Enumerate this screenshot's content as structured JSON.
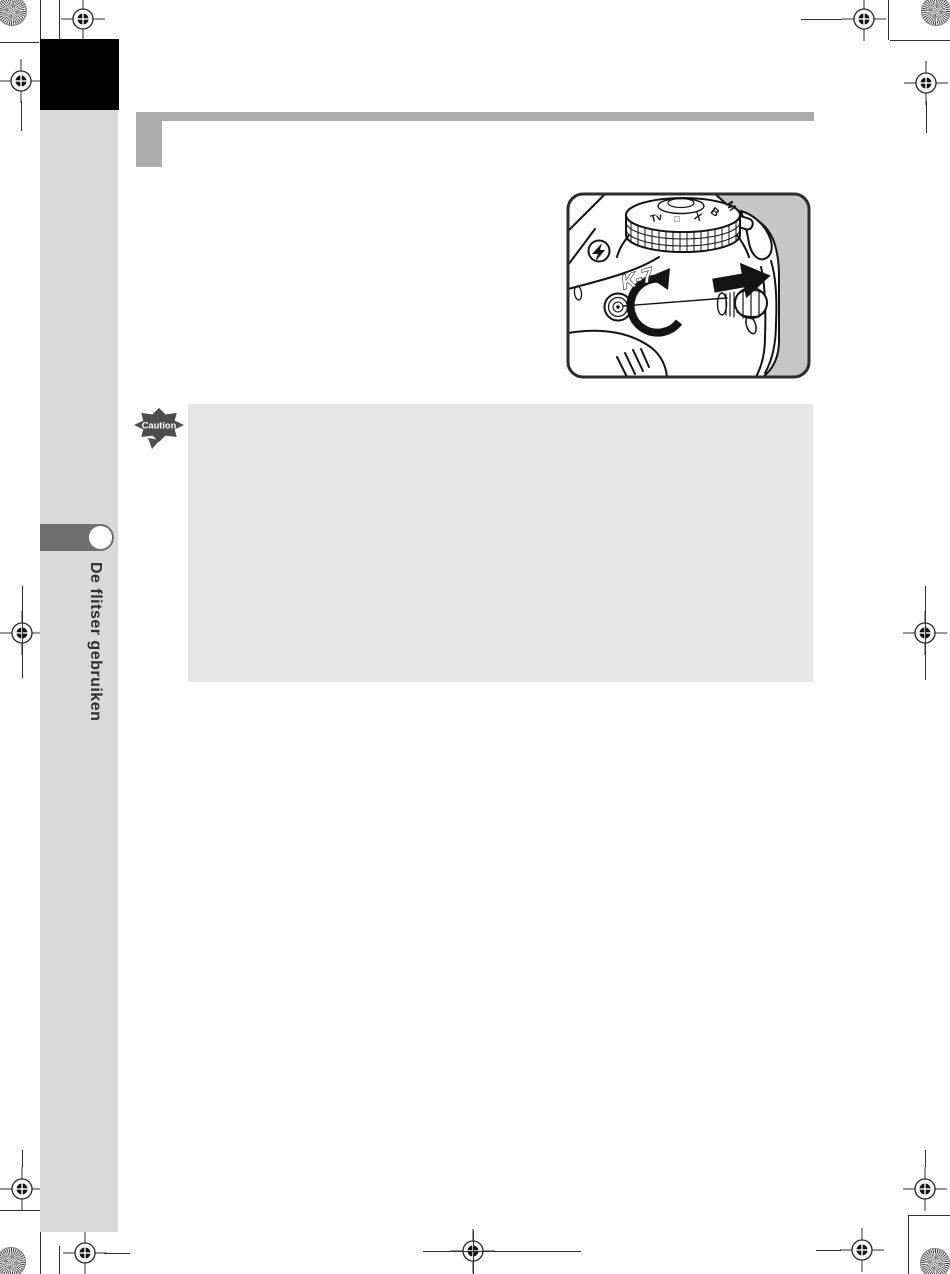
{
  "sidebar": {
    "tab_label": "De flitser gebruiken",
    "band_color": "#d9d9d9",
    "chapter_tab_color": "#000000",
    "pill_color": "#6f6f6f"
  },
  "header": {
    "bar_color": "#ababab"
  },
  "caution": {
    "label": "Caution",
    "icon_color": "#4d4d4d",
    "box_color": "#e7e7e7"
  },
  "illustration": {
    "model": "K-7",
    "dial_marks": [
      "Tv",
      "□",
      "X",
      "B",
      "M"
    ],
    "frame_fill": "#c6c6c6",
    "frame_border": "#2d2d2d"
  },
  "print_marks": {
    "line_color": "#2f2f2f"
  }
}
